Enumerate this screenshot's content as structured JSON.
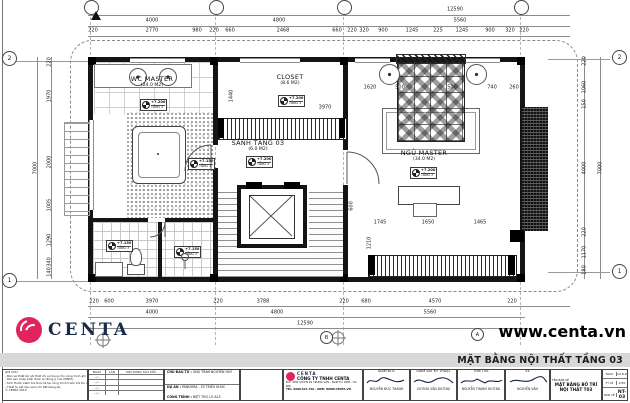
{
  "plan": {
    "rooms": [
      {
        "name": "WC MASTER",
        "area": "(24.0 M2)"
      },
      {
        "name": "CLOSET",
        "area": "(8.6 M2)"
      },
      {
        "name": "SẢNH TẦNG 03",
        "area": "(6.0 M2)"
      },
      {
        "name": "NGỦ MASTER",
        "area": "(34.0 M2)"
      }
    ],
    "levels": [
      {
        "elev": "+7.200",
        "floor": "TẦNG 3"
      },
      {
        "elev": "+7.200",
        "floor": "TẦNG 3"
      },
      {
        "elev": "+7.200",
        "floor": "TẦNG 3"
      },
      {
        "elev": "+7.200",
        "floor": "TẦNG 3"
      },
      {
        "elev": "+7.150",
        "floor": "TẦNG 3"
      },
      {
        "elev": "+7.150",
        "floor": "TẦNG 3"
      },
      {
        "elev": "+7.150",
        "floor": "TẦNG 3"
      }
    ],
    "grid": {
      "left_top": "2",
      "left_bottom": "1",
      "right_top": "2",
      "right_bottom": "1",
      "bottom_b": "B",
      "bottom_a": "A"
    },
    "dims": {
      "top_total": "12590",
      "top_spans": [
        "4000",
        "4800",
        "5560"
      ],
      "top_detail": [
        "220",
        "2770",
        "980",
        "220",
        "660",
        "2468",
        "660",
        "220",
        "320",
        "900",
        "1245",
        "225",
        "1245",
        "900",
        "320",
        "220"
      ],
      "bottom_detail": [
        "220",
        "600",
        "3970",
        "220",
        "3788",
        "220",
        "680",
        "4570",
        "220"
      ],
      "bottom_spans": [
        "4000",
        "4800",
        "5560"
      ],
      "bottom_total": "12590",
      "left_detail": [
        "220",
        "1970",
        "2000",
        "1005",
        "1290",
        "340",
        "140"
      ],
      "left_total": "7000",
      "right_detail": [
        "220",
        "1060",
        "150",
        "4000",
        "220",
        "1170",
        "180"
      ],
      "right_total": "7000",
      "bed_row": [
        "1620",
        "500",
        "500",
        "740",
        "260"
      ],
      "bed_width": "2900",
      "closet_depth": "1440",
      "closet_width": "3970",
      "cabinet_row": [
        "1745",
        "1650",
        "1465"
      ],
      "misc": [
        "1210",
        "600"
      ]
    }
  },
  "brand": {
    "logo_text": "CENTA",
    "website": "www.centa.vn"
  },
  "strip": {
    "title": "MẶT BẰNG NỘI THẤT TẦNG 03"
  },
  "titleblock": {
    "notes": {
      "lines": [
        "GHI CHÚ:",
        "- Bản vẽ thiết kế nội thất chỉ sử dụng cho công trình ghi trên.",
        "- Mọi sao chép phải được sự đồng ý của CENTA.",
        "- Kích thước kiểm tra thực tế tại công trình trước khi thi công.",
        "- Thiết bị vật liệu xem chi tiết bảng kê.",
        "© CENTA 2019"
      ]
    },
    "revisions": {
      "headers": [
        "NGÀY",
        "LẦN",
        "NỘI DUNG SỬA ĐỔI"
      ],
      "rows": [
        "…/…",
        "…/…",
        "…/…",
        "…/…"
      ]
    },
    "project": {
      "rows": [
        {
          "label": "CHỦ ĐẦU TƯ :",
          "value": "ÔNG TRẦN NGUYÊN HUY"
        },
        {
          "label": "DỰ ÁN :",
          "value": "PANDORA - 53 TRIỀU KHÚC"
        },
        {
          "label": "CÔNG TRÌNH :",
          "value": "BIỆT THỰ LÔ A15"
        }
      ]
    },
    "company": {
      "logo": "CENTA",
      "name": "CÔNG TY TNHH CENTA",
      "line1": "Đ/C: NHÀ VƯỜN 49 TRUNG VĂN - NAM TỪ LIÊM - HÀ NỘI",
      "line2": "TEL: 0988.621.750 - WEB: WWW.CENTA.VN"
    },
    "signers": [
      {
        "role": "GIÁM ĐỐC",
        "name": "NGUYỄN ĐỨC THÀNH"
      },
      {
        "role": "GIÁM SÁT KỸ THUẬT",
        "name": "VƯƠNG VĂN DƯƠNG"
      },
      {
        "role": "THIẾT KẾ",
        "name": "NGUYỄN THANH HƯƠNG"
      },
      {
        "role": "VẼ",
        "name": "NGUYỄN VĂN"
      }
    ],
    "drawing": {
      "label": "TÊN BẢN VẼ",
      "title": "MẶT BẰNG BỐ TRÍ NỘI THẤT T03"
    },
    "meta": {
      "rows": [
        {
          "label": "NGÀY",
          "value": "14.8.2019"
        },
        {
          "label": "TỶ LỆ",
          "value": "1/50"
        },
        {
          "label": "BẢN VẼ",
          "value": "NT-03"
        }
      ]
    }
  }
}
